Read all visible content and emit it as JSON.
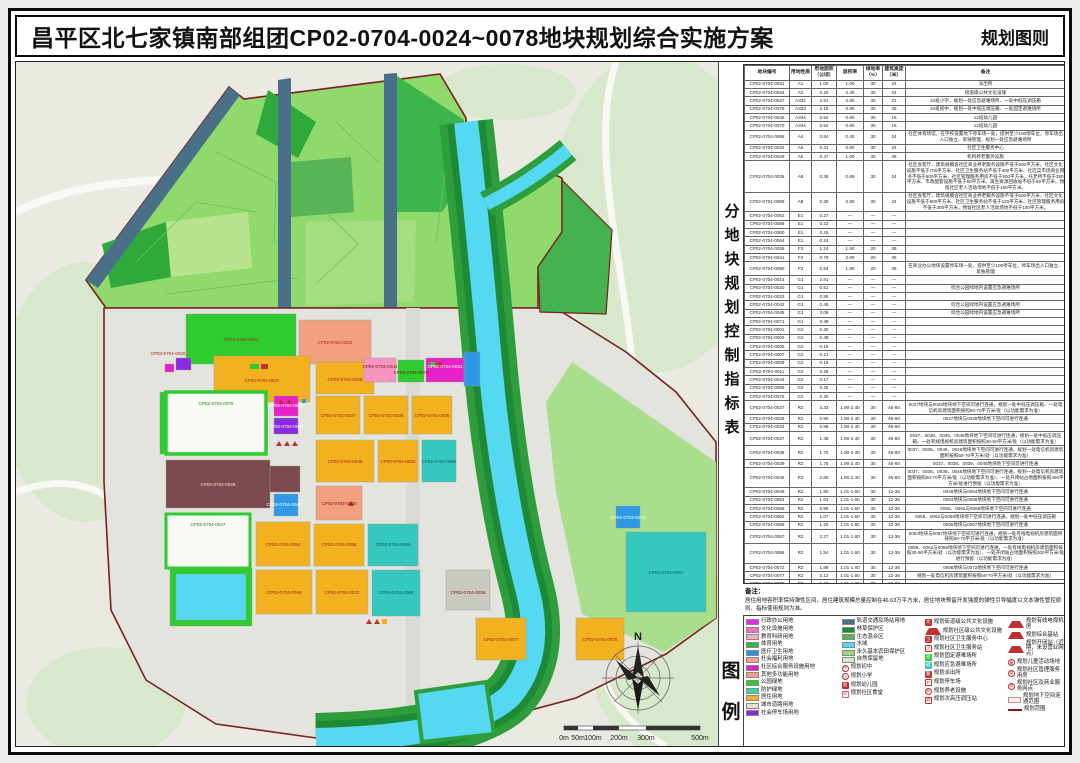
{
  "header": {
    "title": "昌平区北七家镇南部组团CP02-0704-0024~0078地块规划综合实施方案",
    "right_label": "规划图则"
  },
  "table_panel": {
    "vertical_title": "分地块规划控制指标表",
    "columns": [
      "地块编号",
      "用地性质",
      "用地面积（公顷）",
      "容积率",
      "绿地率（%）",
      "建筑高度（米）",
      "备注"
    ],
    "rows": [
      [
        "CP02-0704-0031",
        "A1",
        "1.00",
        "1.00",
        "30",
        "24",
        "派出所"
      ],
      [
        "CP02-0704-0044",
        "A2",
        "0.20",
        "0.40",
        "30",
        "24",
        "街道级公共文化设施"
      ],
      [
        "CP02-0704-0047",
        "A332",
        "2.81",
        "0.80",
        "30",
        "21",
        "24班小学，规划一处应急避难场所、一处中低压调压箱"
      ],
      [
        "CP02-0704-0076",
        "A333",
        "3.18",
        "0.80",
        "30",
        "25",
        "24班初中，规划一处中低压调压箱、一处固定避难场所"
      ],
      [
        "CP02-0704-0045",
        "A334",
        "0.52",
        "0.80",
        "30",
        "16",
        "12班幼儿园"
      ],
      [
        "CP02-0704-0070",
        "A334",
        "0.52",
        "0.80",
        "30",
        "16",
        "12班幼儿园"
      ],
      [
        "CP02-0704-0065",
        "A4",
        "0.84",
        "0.40",
        "30",
        "24",
        "社区体育场馆，在学校设置地下停车场一处，提供至少100停车位，停车场出入口独立、单独管理，规划一处应急避难场所"
      ],
      [
        "CP02-0704-0032",
        "A5",
        "0.31",
        "0.60",
        "30",
        "24",
        "社区卫生服务中心"
      ],
      [
        "CP02-0704-0029",
        "A6",
        "0.47",
        "1.00",
        "30",
        "36",
        "机构养老服务设施"
      ],
      [
        "CP02-0704-0035",
        "A8",
        "0.38",
        "0.89",
        "30",
        "24",
        "社区会客厅，建筑规模含社区商业养老服务设施不低于500平方米、社区文化设施不低于700平方米、社区卫生服务站不低于400平方米、社区菜市场商业网点不低于500平方米、社区管理服务用房不低于500平方米，托老所不低于250平方米、市政配套设施不低于50平方米、再生资源回收站不低于50平方米，预留社区老人活动场地不低于150平方米。"
      ],
      [
        "CP02-0704-0069",
        "A8",
        "0.30",
        "0.90",
        "30",
        "24",
        "社区会客厅，建筑规模含社区商业养老服务设施不低于500平方米、社区文化设施不低于500平方米、社区卫生服务站不低于120平方米、社区管理服务用房不低于300平方米，预留社区老人活动场地不低于100平方米。"
      ],
      [
        "CP02-0704-0052",
        "E1",
        "0.27",
        "—",
        "—",
        "—",
        ""
      ],
      [
        "CP02-0704-0056",
        "E1",
        "0.22",
        "—",
        "—",
        "—",
        ""
      ],
      [
        "CP02-0704-0060",
        "E1",
        "0.26",
        "—",
        "—",
        "—",
        ""
      ],
      [
        "CP02-0704-0064",
        "E1",
        "0.24",
        "—",
        "—",
        "—",
        ""
      ],
      [
        "CP02-0704-0026",
        "F3",
        "1.24",
        "1.50",
        "20",
        "36",
        ""
      ],
      [
        "CP02-0704-0041",
        "F3",
        "0.70",
        "2.00",
        "20",
        "36",
        ""
      ],
      [
        "CP02-0704-0050",
        "F3",
        "0.84",
        "1.80",
        "20",
        "36",
        "在商业办公地块设置停车场一处，提供至少100停车位，停车场出入口独立、单独管理"
      ],
      [
        "CP02-0704-0014",
        "G1",
        "2.81",
        "—",
        "—",
        "—",
        ""
      ],
      [
        "CP02-0704-0020",
        "G1",
        "0.51",
        "—",
        "—",
        "—",
        "综合公园绿地内设置应急避难场所"
      ],
      [
        "CP02-0704-0023",
        "G1",
        "0.89",
        "—",
        "—",
        "—",
        ""
      ],
      [
        "CP02-0704-0042",
        "G1",
        "0.49",
        "—",
        "—",
        "—",
        "综合公园绿地内设置应急避难场所"
      ],
      [
        "CP02-0704-0048",
        "G1",
        "3.06",
        "—",
        "—",
        "—",
        "综合公园绿地内设置应急避难场所"
      ],
      [
        "CP02-0704-0071",
        "G1",
        "0.48",
        "—",
        "—",
        "—",
        ""
      ],
      [
        "CP02-0704-0001",
        "G2",
        "0.30",
        "—",
        "—",
        "—",
        ""
      ],
      [
        "CP02-0704-0003",
        "G2",
        "0.38",
        "—",
        "—",
        "—",
        ""
      ],
      [
        "CP02-0704-0005",
        "G2",
        "0.16",
        "—",
        "—",
        "—",
        ""
      ],
      [
        "CP02-0704-0007",
        "G2",
        "0.21",
        "—",
        "—",
        "—",
        ""
      ],
      [
        "CP02-0704-0009",
        "G2",
        "0.19",
        "—",
        "—",
        "—",
        ""
      ],
      [
        "CP02-0704-0011",
        "G2",
        "0.26",
        "—",
        "—",
        "—",
        ""
      ],
      [
        "CP02-0704-0043",
        "G2",
        "0.17",
        "—",
        "—",
        "—",
        ""
      ],
      [
        "CP02-0704-0055",
        "G2",
        "0.25",
        "—",
        "—",
        "—",
        ""
      ],
      [
        "CP02-0704-0075",
        "G2",
        "0.30",
        "—",
        "—",
        "—",
        ""
      ],
      [
        "CP02-0704-0027",
        "R2",
        "3.33",
        "1.90-2.40",
        "30",
        "45-60",
        "0027地块与0028地块地下空间可进行连通，规划一处中低压调压箱、一处电信机房建筑面积按照50-70平方米/处（以功能需求为准）"
      ],
      [
        "CP02-0704-0028",
        "R2",
        "0.90",
        "1.90-2.40",
        "30",
        "45-60",
        "0027地块与0028地块地下空间可进行连通"
      ],
      [
        "CP02-0704-0034",
        "R2",
        "0.88",
        "1.90-2.40",
        "30",
        "45-60",
        ""
      ],
      [
        "CP02-0704-0037",
        "R2",
        "1.38",
        "1.90-2.40",
        "30",
        "45-60",
        "0037、0038、0039、0046地块地下空间可进行连通，规划一处中低压调压箱、一处有线电视机房建筑面积按照30-50平方米/处（以功能需求为准）"
      ],
      [
        "CP02-0704-0038",
        "R2",
        "1.70",
        "1.90-2.40",
        "30",
        "45-60",
        "0037、0038、0039、0046地块地下空间可进行连通，规划一处电信机房建筑面积按照50-70平方米/处（以功能需求为准）"
      ],
      [
        "CP02-0704-0039",
        "R2",
        "1.75",
        "1.90-2.40",
        "30",
        "45-60",
        "0037、0038、0039、0046地块地下空间可进行连通"
      ],
      [
        "CP02-0704-0046",
        "R2",
        "2.60",
        "1.90-2.40",
        "30",
        "45-60",
        "0037、0038、0039、0046地块地下空间可进行连通，规划一处电信机房建筑面积按照50-70平方米/处（以功能需求为准）、一处开闭站占地面积按照300平方米/处进行预留（以功能需求为准）"
      ],
      [
        "CP02-0704-0049",
        "R2",
        "1.90",
        "1.01-1.60",
        "30",
        "12-36",
        "0049地块与0054地块地下空间可进行连通"
      ],
      [
        "CP02-0704-0054",
        "R2",
        "1.63",
        "1.01-1.60",
        "30",
        "12-36",
        "0054地块与0058地块地下空间可进行连通"
      ],
      [
        "CP02-0704-0058",
        "R2",
        "0.99",
        "1.01-1.60",
        "30",
        "12-36",
        "0058、0062与0068地块地下空间可进行连通"
      ],
      [
        "CP02-0704-0062",
        "R2",
        "1.07",
        "1.01-1.60",
        "30",
        "12-36",
        "0058、0062与0068地块地下空间可进行连通，规划一处中低压调压箱"
      ],
      [
        "CP02-0704-0066",
        "R2",
        "1.20",
        "1.01-1.60",
        "30",
        "12-36",
        "0066地块与0067地块地下空间可进行连通"
      ],
      [
        "CP02-0704-0067",
        "R2",
        "2.27",
        "1.01-1.60",
        "30",
        "12-36",
        "0054地块与0067地块地下空间可进行连通，规划一处有线电视机房建筑面积按照50-70平方米/处（以功能需求为准）"
      ],
      [
        "CP02-0704-0068",
        "R2",
        "1.54",
        "1.01-1.60",
        "30",
        "12-36",
        "0058、0062与0068地块地下空间可进行连通，一处有线电视机房建筑面积按照30-50平方米/处（以功能需求为准）、一处开闭站占地面积按照300平方米/处进行预留（以功能需求为准）"
      ],
      [
        "CP02-0704-0072",
        "R2",
        "1.89",
        "1.01-1.60",
        "30",
        "12-36",
        "0066地块与0072地块地下空间可进行连通"
      ],
      [
        "CP02-0704-0077",
        "R2",
        "2.12",
        "1.01-1.60",
        "30",
        "12-36",
        "规划一处电信机房建筑面积按照50-70平方米/处（以功能需求为准）"
      ],
      [
        "CP02-0704-0078",
        "R2",
        "1.47",
        "1.01-1.60",
        "30",
        "12-36",
        ""
      ],
      [
        "CP02-0704-0036",
        "S4",
        "0.39",
        "0.20",
        "—",
        "—",
        "停车楼，提供至少215个停车位"
      ],
      [
        "CP02-0704-0025",
        "U12",
        "0.10",
        "0.30",
        "—",
        "24",
        "规划110千伏变电站"
      ],
      [
        "CP02-0704-0040",
        "U14",
        "0.44",
        "0.80",
        "—",
        "24",
        "能源站"
      ],
      [
        "CP02-0704-0073",
        "U14",
        "0.40",
        "0.80",
        "—",
        "24",
        "能源站"
      ],
      [
        "CP02-0704-0016",
        "U22",
        "0.19",
        "0.40",
        "—",
        "24",
        "密闭式垃圾分类收集站"
      ],
      [
        "—",
        "轨",
        "1.89",
        "—",
        "—",
        "—",
        "全市动力管廊用地，具体规划指标及使用另行编制规划综合实施方案确定。"
      ],
      [
        "—",
        "轨",
        "0.92",
        "—",
        "—",
        "—",
        "全市动力管廊用地，具体规划指标及使用另行编制规划综合实施方案确定。"
      ],
      [
        "—",
        "合计",
        "28.31",
        "—",
        "—",
        "—",
        ""
      ]
    ]
  },
  "note": {
    "label": "备注：",
    "text": "居住用地容积率保持弹性区间，居住建筑规模总量控制在46.63万平方米，居住地块预留开发强度的弹性引导幅度以文本弹性管控原则、指标使用规则为准。"
  },
  "legend": {
    "vertical_title_1": "图",
    "vertical_title_2": "例",
    "col1": [
      {
        "label": "行政办公用地",
        "type": "swatch",
        "color": "#E02CE0"
      },
      {
        "label": "文化设施用地",
        "type": "swatch",
        "color": "#F06EC8"
      },
      {
        "label": "教育科研用地",
        "type": "swatch",
        "color": "#F9A8C9"
      },
      {
        "label": "体育用地",
        "type": "swatch",
        "color": "#35B24A"
      },
      {
        "label": "医疗卫生用地",
        "type": "swatch",
        "color": "#2D8FE0"
      },
      {
        "label": "社会福利用地",
        "type": "swatch",
        "color": "#F2A0A0"
      },
      {
        "label": "社区综合服务设施用地",
        "type": "swatch",
        "color": "#E020C8"
      },
      {
        "label": "其他多功能用地",
        "type": "swatch",
        "color": "#F2A07E"
      },
      {
        "label": "公园绿地",
        "type": "swatch",
        "color": "#2ECC2E"
      },
      {
        "label": "防护绿地",
        "type": "swatch",
        "color": "#35D8A0"
      },
      {
        "label": "居住用地",
        "type": "swatch",
        "color": "#F2B21F"
      },
      {
        "label": "城市道路用地",
        "type": "swatch",
        "color": "#E0E0DC"
      },
      {
        "label": "社会停车场用地",
        "type": "swatch",
        "color": "#8A2BE2"
      }
    ],
    "col2": [
      {
        "label": "轨道交通及场站用地",
        "type": "swatch",
        "color": "#4A7089"
      },
      {
        "label": "林草保护区",
        "type": "swatch",
        "color": "#1F8A35"
      },
      {
        "label": "生态混合区",
        "type": "swatch",
        "color": "#57B457"
      },
      {
        "label": "水域",
        "type": "swatch",
        "color": "#55D8F2"
      },
      {
        "label": "永久基本农田保护区",
        "type": "swatch",
        "color": "#9ADB7A"
      },
      {
        "label": "自然保留地",
        "type": "swatch",
        "color": "#D2EFC4"
      },
      {
        "label": "规划初中",
        "type": "circle",
        "color": "#C03030",
        "glyph": "中"
      },
      {
        "label": "规划小学",
        "type": "circle",
        "color": "#C03030",
        "glyph": "小"
      },
      {
        "label": "规划幼儿园",
        "type": "badge",
        "color": "#C03030",
        "glyph": "幼"
      },
      {
        "label": "规划社区食堂",
        "type": "badge-outline",
        "color": "#D06A6A",
        "glyph": "食"
      }
    ],
    "col3": [
      {
        "label": "规划街道级公共文化设施",
        "type": "badge",
        "color": "#C03030",
        "glyph": "文"
      },
      {
        "label": "规划社区级公共文化设施",
        "type": "tri",
        "color": "#C03030"
      },
      {
        "label": "规划社区卫生服务中心",
        "type": "badge",
        "color": "#C03030",
        "glyph": "卫"
      },
      {
        "label": "规划社区卫生服务站",
        "type": "badge-outline",
        "color": "#C03030",
        "glyph": "卫"
      },
      {
        "label": "规划固定避难场所",
        "type": "badge",
        "color": "#2ECC2E",
        "glyph": "避"
      },
      {
        "label": "规划应急避难场所",
        "type": "badge",
        "color": "#35C8BE",
        "glyph": "避"
      },
      {
        "label": "规划派出所",
        "type": "badge",
        "color": "#C03030",
        "glyph": "警"
      },
      {
        "label": "规划停车场",
        "type": "badge-outline",
        "color": "#C03030",
        "glyph": "P"
      },
      {
        "label": "规划养老设施",
        "type": "circle",
        "color": "#C03030",
        "glyph": "养"
      },
      {
        "label": "规划次高压调压站",
        "type": "badge-outline",
        "color": "#C03030",
        "glyph": "调"
      }
    ],
    "col4": [
      {
        "label": "规划有线电视机房",
        "type": "tri",
        "color": "#C03030"
      },
      {
        "label": "规划综合基站",
        "type": "tri",
        "color": "#C03030"
      },
      {
        "label": "规划开闭站（近期，未设营业网点）",
        "type": "tri",
        "color": "#C03030"
      },
      {
        "label": "规划儿童活动场地",
        "type": "circle",
        "color": "#C03030",
        "glyph": "童"
      },
      {
        "label": "规划社区管理服务用房",
        "type": "circle",
        "color": "#C03030",
        "glyph": "管"
      },
      {
        "label": "规划社区及商业服务网点",
        "type": "circle",
        "color": "#C03030",
        "glyph": "商"
      },
      {
        "label": "规划地下空间连通范围",
        "type": "outline",
        "color": "#C09090"
      },
      {
        "label": "规划范围",
        "type": "line",
        "color": "#8B1A1A"
      }
    ]
  },
  "map": {
    "north_label": "N",
    "boundary_color": "#7A1F1F",
    "river_color": "#55D8F2",
    "field_color": "#8FD96D",
    "scale_labels": [
      {
        "t": "0m",
        "x": 548
      },
      {
        "t": "50m",
        "x": 562
      },
      {
        "t": "100m",
        "x": 577
      },
      {
        "t": "200m",
        "x": 603
      },
      {
        "t": "300m",
        "x": 630
      },
      {
        "t": "500m",
        "x": 684
      }
    ],
    "plot_labels": [
      {
        "t": "CP02-0704-0014",
        "x": 225,
        "y": 279,
        "c": "#A82020"
      },
      {
        "t": "CP02-0704-0023",
        "x": 319,
        "y": 282,
        "c": "#A82020"
      },
      {
        "t": "CP02-0704-0020",
        "x": 152,
        "y": 293,
        "c": "#A82020"
      },
      {
        "t": "CP02-0704-0027",
        "x": 246,
        "y": 320,
        "c": "#A82020"
      },
      {
        "t": "CP02-0704-0028",
        "x": 329,
        "y": 319,
        "c": "#A82020"
      },
      {
        "t": "CP02-0704-0044",
        "x": 364,
        "y": 306,
        "c": "#7A1010"
      },
      {
        "t": "CP02-0704-0070",
        "x": 395,
        "y": 312,
        "c": "#7A1010"
      },
      {
        "t": "CP02-0704-0031",
        "x": 429,
        "y": 306,
        "c": "#ffffff"
      },
      {
        "t": "CP02-0704-0076",
        "x": 200,
        "y": 343,
        "c": "#1C7A1C"
      },
      {
        "t": "CP02-0704-0037",
        "x": 322,
        "y": 355,
        "c": "#A82020"
      },
      {
        "t": "CP02-0704-0038",
        "x": 370,
        "y": 355,
        "c": "#A82020"
      },
      {
        "t": "CP02-0704-0039",
        "x": 416,
        "y": 355,
        "c": "#A82020"
      },
      {
        "t": "CP02-0704-0035",
        "x": 270,
        "y": 345,
        "c": "#ffffff"
      },
      {
        "t": "CP02-0704-0032",
        "x": 270,
        "y": 366,
        "c": "#ffffff"
      },
      {
        "t": "CP02-0704-0026",
        "x": 202,
        "y": 424,
        "c": "#FFE9C9"
      },
      {
        "t": "CP02-0704-0046",
        "x": 329,
        "y": 401,
        "c": "#A82020"
      },
      {
        "t": "CP02-0704-0034",
        "x": 382,
        "y": 401,
        "c": "#A82020"
      },
      {
        "t": "CP02-0704-0062",
        "x": 423,
        "y": 401,
        "c": "#075A52"
      },
      {
        "t": "CP02-0704-0050",
        "x": 323,
        "y": 443,
        "c": "#7A1010"
      },
      {
        "t": "CP02-0704-0047",
        "x": 192,
        "y": 464,
        "c": "#1C7A1C"
      },
      {
        "t": "CP02-0704-0054",
        "x": 267,
        "y": 484,
        "c": "#A82020"
      },
      {
        "t": "CP02-0704-0058",
        "x": 323,
        "y": 484,
        "c": "#A82020"
      },
      {
        "t": "CP02-0704-0066",
        "x": 377,
        "y": 484,
        "c": "#075A52"
      },
      {
        "t": "CP02-0704-0049",
        "x": 268,
        "y": 532,
        "c": "#A82020"
      },
      {
        "t": "CP02-0704-0072",
        "x": 326,
        "y": 532,
        "c": "#A82020"
      },
      {
        "t": "CP02-0704-0068",
        "x": 380,
        "y": 532,
        "c": "#075A52"
      },
      {
        "t": "CP02-0704-0077",
        "x": 485,
        "y": 579,
        "c": "#A82020"
      },
      {
        "t": "CP02-0704-0078",
        "x": 584,
        "y": 579,
        "c": "#A82020"
      },
      {
        "t": "CP02-0704-0073",
        "x": 612,
        "y": 457,
        "c": "#ffffff"
      },
      {
        "t": "CP02-0704-0067",
        "x": 650,
        "y": 512,
        "c": "#075A52"
      },
      {
        "t": "CP02-0704-0036",
        "x": 452,
        "y": 532,
        "c": "#7A1010"
      },
      {
        "t": "CP02-0704-0041",
        "x": 268,
        "y": 444,
        "c": "#ffffff"
      }
    ]
  }
}
